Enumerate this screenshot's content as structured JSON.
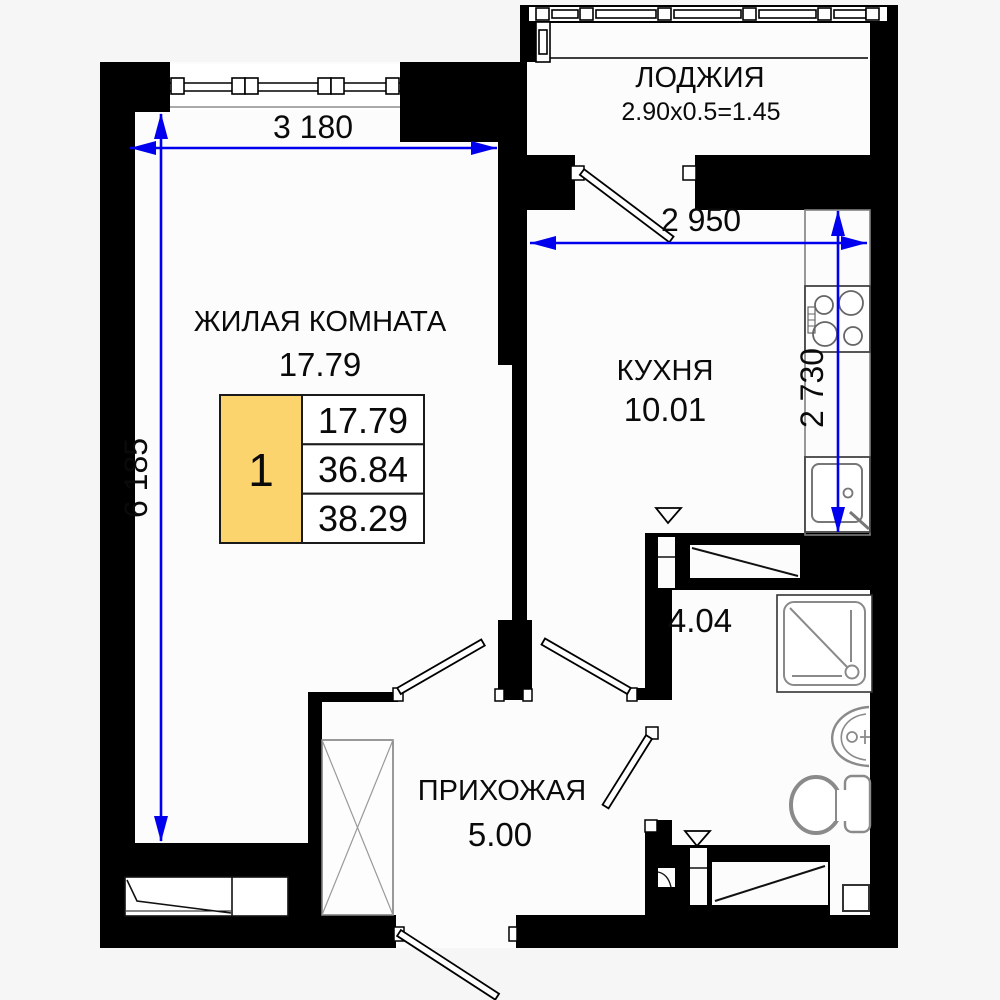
{
  "plan": {
    "rooms": {
      "living": {
        "name": "ЖИЛАЯ КОМНАТА",
        "area": "17.79"
      },
      "loggia": {
        "name": "ЛОДЖИЯ",
        "size_formula": "2.90x0.5=1.45"
      },
      "kitchen": {
        "name": "КУХНЯ",
        "area": "10.01"
      },
      "hallway": {
        "name": "ПРИХОЖАЯ",
        "area": "5.00"
      },
      "bathroom": {
        "area": "4.04"
      }
    },
    "dimensions": {
      "living_width": "3 180",
      "living_depth": "6 185",
      "kitchen_width": "2 950",
      "kitchen_depth": "2 730"
    },
    "legend": {
      "rooms_count": "1",
      "living_area": "17.79",
      "area_without_loggia": "36.84",
      "total_area": "38.29"
    },
    "colors": {
      "dimension": "#0000ee",
      "legend_fill": "#fbd46d",
      "wall": "#000000"
    }
  }
}
